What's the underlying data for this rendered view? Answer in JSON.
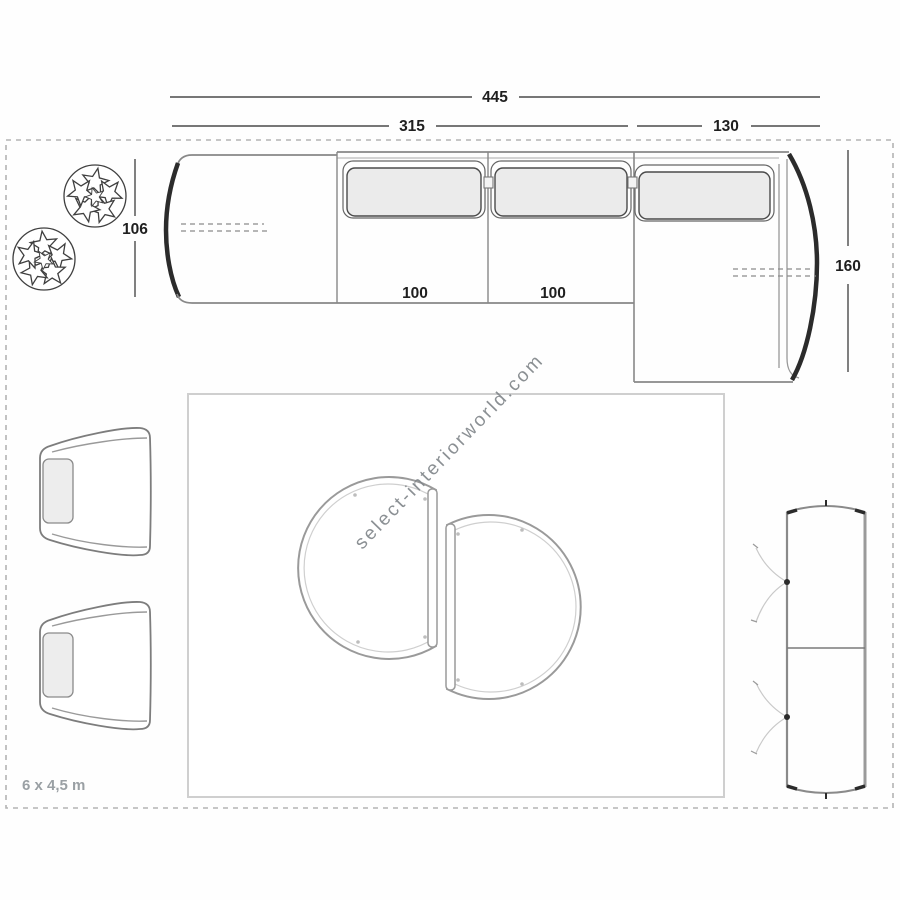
{
  "watermark": {
    "text": "select-interiorworld.com"
  },
  "plan": {
    "room_size_label": "6 x 4,5 m",
    "dimensions": {
      "overall_width": "445",
      "left_section_width": "315",
      "chaise_section_width": "130",
      "sofa_depth_left": "106",
      "seat_module_1": "100",
      "seat_module_2": "100",
      "chaise_depth": "160"
    },
    "furniture": [
      "modular-sofa-with-right-chaise",
      "plant",
      "plant",
      "armchair",
      "armchair",
      "rug",
      "half-round-coffee-table",
      "half-round-coffee-table",
      "two-door-sideboard"
    ],
    "colors": {
      "outline_dark": "#2b2b2b",
      "outline_gray": "#888888",
      "cushion_fill": "#ebebeb",
      "dashed_room_border": "#b3b3b3",
      "rug_border": "#cfcfcf",
      "dimension_text": "#1f1f1f",
      "room_label_text": "#9aa0a4",
      "watermark_text": "#82878b"
    }
  }
}
